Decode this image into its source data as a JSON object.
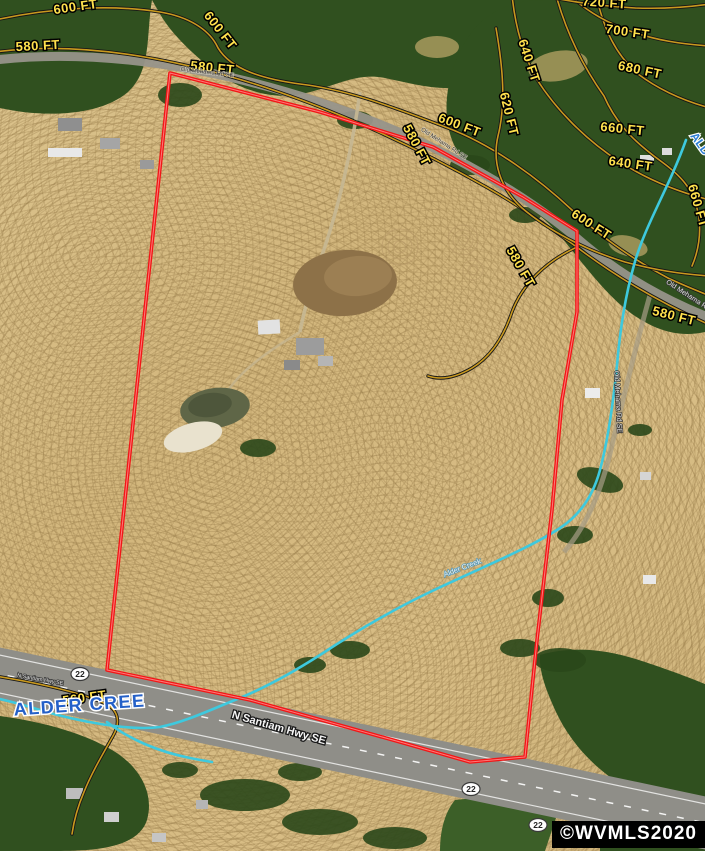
{
  "map": {
    "watermark": "©WVMLS2020",
    "shield_label": "22",
    "contour_labels": [
      "600 FT",
      "580 FT",
      "580 FT",
      "600 FT",
      "600 FT",
      "580 FT",
      "700 FT",
      "720 FT",
      "640 FT",
      "680 FT",
      "620 FT",
      "660 FT",
      "640 FT",
      "660 FT",
      "600 FT",
      "580 FT",
      "580 FT",
      "560 FT"
    ],
    "road_labels": [
      "Old Mehama Rd SE",
      "Old Mehama Rd SE",
      "Old Mehama Rd",
      "Old Mehama Rd SE",
      "N Santiam Hwy SE",
      "N Santiam Hwy SE"
    ],
    "creek_labels": [
      "Alder Creek",
      "ALDER CREE",
      "ALD"
    ],
    "colors": {
      "boundary": "#f21616",
      "creek": "#3ec9de",
      "contour_line": "#c9991e",
      "contour_label": "#ffe14d",
      "creek_label_blue": "#2460c8",
      "field": "#d7bd86",
      "forest": "#30501f",
      "watermark_bg": "#000000",
      "watermark_text": "#ffffff"
    }
  }
}
